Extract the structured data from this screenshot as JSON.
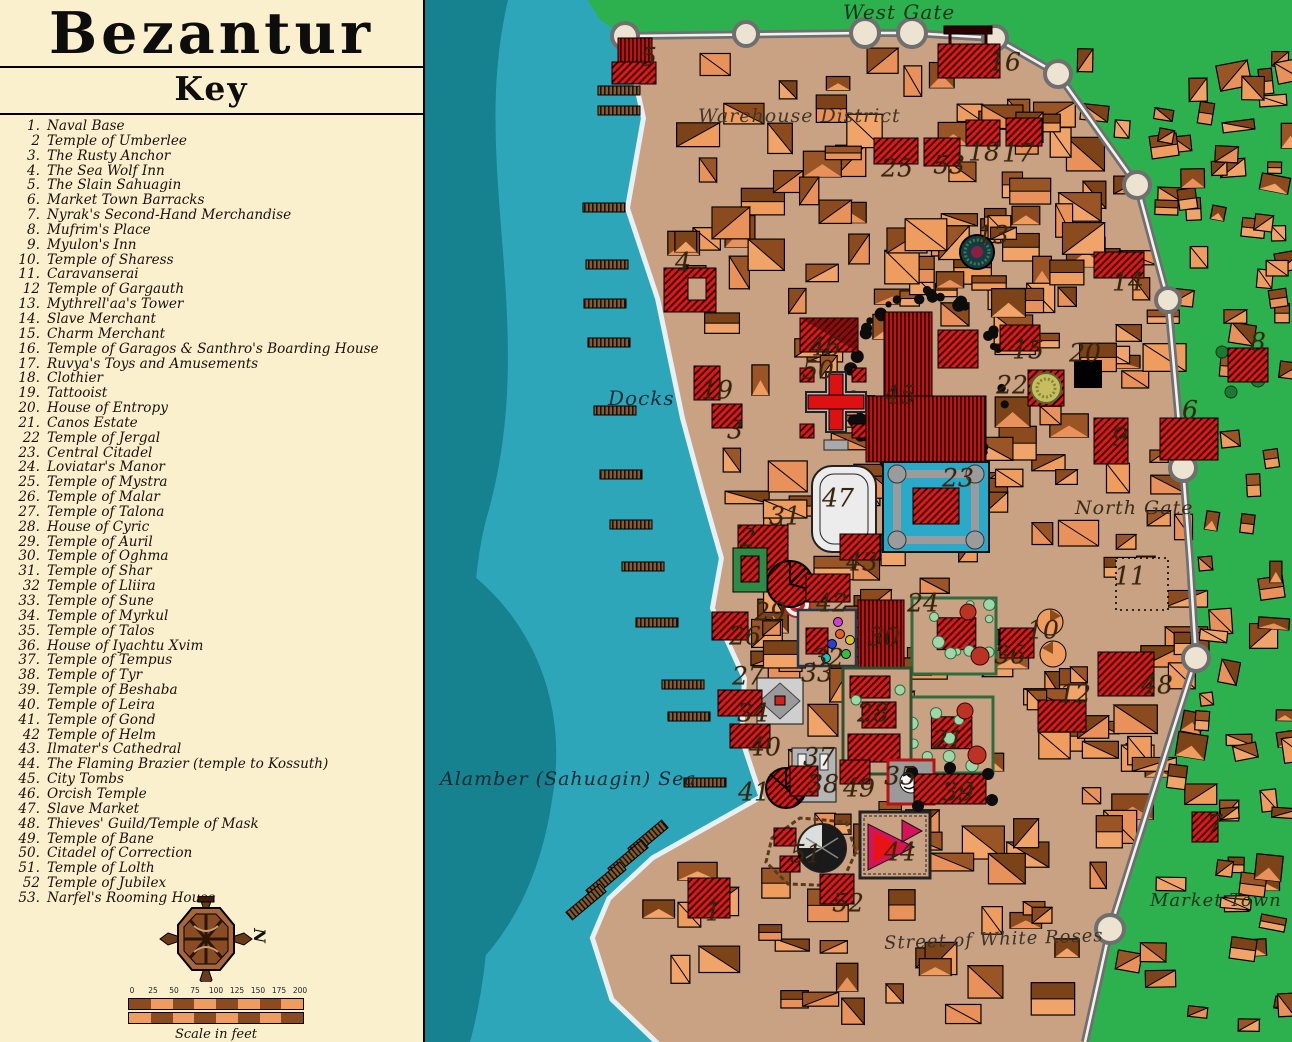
{
  "panel": {
    "title": "Bezantur",
    "subtitle": "Key",
    "items": [
      {
        "num": "1.",
        "label": "Naval Base"
      },
      {
        "num": "2",
        "label": "Temple of Umberlee"
      },
      {
        "num": "3.",
        "label": "The Rusty Anchor"
      },
      {
        "num": "4.",
        "label": "The Sea Wolf Inn"
      },
      {
        "num": "5.",
        "label": "The Slain Sahuagin"
      },
      {
        "num": "6.",
        "label": "Market Town Barracks"
      },
      {
        "num": "7.",
        "label": "Nyrak's Second-Hand Merchandise"
      },
      {
        "num": "8.",
        "label": "Mufrim's Place"
      },
      {
        "num": "9.",
        "label": "Myulon's Inn"
      },
      {
        "num": "10.",
        "label": "Temple of Sharess"
      },
      {
        "num": "11.",
        "label": "Caravanserai"
      },
      {
        "num": "12",
        "label": "Temple of Gargauth"
      },
      {
        "num": "13.",
        "label": "Mythrell'aa's Tower"
      },
      {
        "num": "14.",
        "label": "Slave Merchant"
      },
      {
        "num": "15.",
        "label": "Charm Merchant"
      },
      {
        "num": "16.",
        "label": "Temple of Garagos & Santhro's Boarding House"
      },
      {
        "num": "17.",
        "label": "Ruvya's Toys and Amusements"
      },
      {
        "num": "18.",
        "label": "Clothier"
      },
      {
        "num": "19.",
        "label": "Tattooist"
      },
      {
        "num": "20.",
        "label": "House of Entropy"
      },
      {
        "num": "21.",
        "label": "Canos Estate"
      },
      {
        "num": "22",
        "label": "Temple of Jergal"
      },
      {
        "num": "23.",
        "label": "Central Citadel"
      },
      {
        "num": "24.",
        "label": "Loviatar's Manor"
      },
      {
        "num": "25.",
        "label": "Temple of Mystra"
      },
      {
        "num": "26.",
        "label": "Temple of Malar"
      },
      {
        "num": "27.",
        "label": "Temple of Talona"
      },
      {
        "num": "28.",
        "label": "House of Cyric"
      },
      {
        "num": "29.",
        "label": "Temple of Auril"
      },
      {
        "num": "30.",
        "label": "Temple of Oghma"
      },
      {
        "num": "31.",
        "label": "Temple of Shar"
      },
      {
        "num": "32",
        "label": "Temple of Lliira"
      },
      {
        "num": "33.",
        "label": "Temple of Sune"
      },
      {
        "num": "34.",
        "label": "Temple of Myrkul"
      },
      {
        "num": "35.",
        "label": "Temple of Talos"
      },
      {
        "num": "36.",
        "label": "House of Iyachtu Xvim"
      },
      {
        "num": "37.",
        "label": "Temple of Tempus"
      },
      {
        "num": "38.",
        "label": "Temple of Tyr"
      },
      {
        "num": "39.",
        "label": "Temple of Beshaba"
      },
      {
        "num": "40.",
        "label": "Temple of Leira"
      },
      {
        "num": "41.",
        "label": "Temple of Gond"
      },
      {
        "num": "42",
        "label": "Temple of Helm"
      },
      {
        "num": "43.",
        "label": "Ilmater's Cathedral"
      },
      {
        "num": "44.",
        "label": "The Flaming Brazier (temple to Kossuth)"
      },
      {
        "num": "45.",
        "label": "City Tombs"
      },
      {
        "num": "46.",
        "label": "Orcish Temple"
      },
      {
        "num": "47.",
        "label": "Slave Market"
      },
      {
        "num": "48.",
        "label": "Thieves' Guild/Temple of Mask"
      },
      {
        "num": "49.",
        "label": "Temple of Bane"
      },
      {
        "num": "50.",
        "label": "Citadel of Correction"
      },
      {
        "num": "51.",
        "label": "Temple of Lolth"
      },
      {
        "num": "52",
        "label": "Temple of Jubilex"
      },
      {
        "num": "53.",
        "label": "Narfel's Rooming House"
      }
    ],
    "compass_label": "N",
    "scale": {
      "ticks": [
        "0",
        "25",
        "50",
        "75",
        "100",
        "125",
        "150",
        "175",
        "200"
      ],
      "caption": "Scale in feet"
    }
  },
  "map": {
    "labels": [
      {
        "text": "West Gate",
        "x": 843,
        "y": 0,
        "size": 20,
        "color": "#17351b",
        "rot": 0
      },
      {
        "text": "Warehouse District",
        "x": 698,
        "y": 105,
        "size": 19,
        "color": "#423725",
        "rot": 0
      },
      {
        "text": "Docks",
        "x": 608,
        "y": 386,
        "size": 20,
        "color": "#122e38",
        "rot": 0
      },
      {
        "text": "North Gate",
        "x": 1075,
        "y": 497,
        "size": 19,
        "color": "#3a2d18",
        "rot": 0
      },
      {
        "text": "Alamber (Sahuagin) Sea",
        "x": 440,
        "y": 768,
        "size": 19,
        "color": "#102a33",
        "rot": 0
      },
      {
        "text": "Market Town",
        "x": 1150,
        "y": 890,
        "size": 18,
        "color": "#23351f",
        "rot": 0
      },
      {
        "text": "Street of White Roses",
        "x": 884,
        "y": 929,
        "size": 18,
        "color": "#3b332a",
        "rot": -2
      }
    ],
    "markers": [
      {
        "num": "1",
        "x": 713,
        "y": 912
      },
      {
        "num": "2",
        "x": 748,
        "y": 538
      },
      {
        "num": "3",
        "x": 735,
        "y": 430
      },
      {
        "num": "4",
        "x": 683,
        "y": 262
      },
      {
        "num": "5",
        "x": 649,
        "y": 57
      },
      {
        "num": "6",
        "x": 1190,
        "y": 410
      },
      {
        "num": "7",
        "x": 1215,
        "y": 824
      },
      {
        "num": "8",
        "x": 1258,
        "y": 342
      },
      {
        "num": "9",
        "x": 1120,
        "y": 437
      },
      {
        "num": "10",
        "x": 1043,
        "y": 630
      },
      {
        "num": "11",
        "x": 1130,
        "y": 576
      },
      {
        "num": "12",
        "x": 1075,
        "y": 694
      },
      {
        "num": "13",
        "x": 993,
        "y": 235
      },
      {
        "num": "14",
        "x": 1128,
        "y": 282
      },
      {
        "num": "15",
        "x": 1028,
        "y": 350
      },
      {
        "num": "16",
        "x": 1005,
        "y": 62
      },
      {
        "num": "17",
        "x": 1018,
        "y": 153
      },
      {
        "num": "18",
        "x": 984,
        "y": 152
      },
      {
        "num": "19",
        "x": 717,
        "y": 390
      },
      {
        "num": "20",
        "x": 1085,
        "y": 353
      },
      {
        "num": "21",
        "x": 948,
        "y": 740
      },
      {
        "num": "22",
        "x": 1012,
        "y": 385
      },
      {
        "num": "23",
        "x": 958,
        "y": 478
      },
      {
        "num": "24",
        "x": 923,
        "y": 603
      },
      {
        "num": "25",
        "x": 897,
        "y": 168
      },
      {
        "num": "26",
        "x": 745,
        "y": 636
      },
      {
        "num": "27",
        "x": 748,
        "y": 676
      },
      {
        "num": "28",
        "x": 873,
        "y": 713
      },
      {
        "num": "29",
        "x": 770,
        "y": 612
      },
      {
        "num": "30",
        "x": 884,
        "y": 637
      },
      {
        "num": "31",
        "x": 785,
        "y": 516
      },
      {
        "num": "32",
        "x": 828,
        "y": 658
      },
      {
        "num": "33",
        "x": 817,
        "y": 673
      },
      {
        "num": "34",
        "x": 753,
        "y": 713
      },
      {
        "num": "35",
        "x": 900,
        "y": 776
      },
      {
        "num": "36",
        "x": 1010,
        "y": 655
      },
      {
        "num": "37",
        "x": 819,
        "y": 757
      },
      {
        "num": "38",
        "x": 823,
        "y": 784
      },
      {
        "num": "39",
        "x": 958,
        "y": 792
      },
      {
        "num": "40",
        "x": 765,
        "y": 747
      },
      {
        "num": "41",
        "x": 754,
        "y": 792
      },
      {
        "num": "42",
        "x": 832,
        "y": 603
      },
      {
        "num": "43",
        "x": 862,
        "y": 562
      },
      {
        "num": "44",
        "x": 900,
        "y": 852
      },
      {
        "num": "45",
        "x": 900,
        "y": 395
      },
      {
        "num": "46",
        "x": 825,
        "y": 347
      },
      {
        "num": "47",
        "x": 838,
        "y": 498
      },
      {
        "num": "48",
        "x": 1157,
        "y": 685
      },
      {
        "num": "49",
        "x": 859,
        "y": 788
      },
      {
        "num": "50",
        "x": 818,
        "y": 370
      },
      {
        "num": "51",
        "x": 806,
        "y": 854
      },
      {
        "num": "52",
        "x": 848,
        "y": 903
      },
      {
        "num": "53",
        "x": 949,
        "y": 165
      }
    ]
  },
  "colors": {
    "panel_bg": "#FBF0CE",
    "sea_light": "#2EA6BA",
    "sea_dark": "#16818F",
    "foam": "#E7F1F5",
    "land": "#C9A183",
    "grass": "#2DB04E",
    "wall": "#6F6F6F",
    "road": "#F2F2F2",
    "tower": "#ECE4D0",
    "bld_light": "#EF9C5F",
    "bld_dark": "#8C4B1E",
    "red": "#E31515",
    "dark_red": "#8B0A0A",
    "moat": "#2AA9C9"
  }
}
